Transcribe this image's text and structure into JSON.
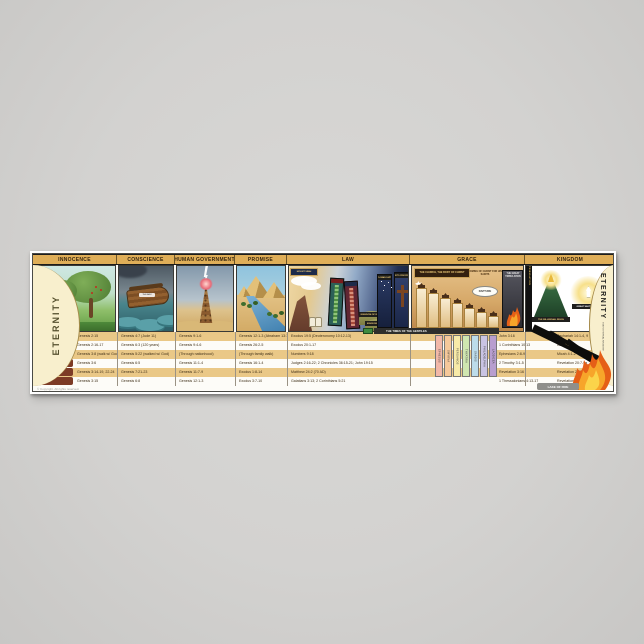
{
  "colors": {
    "page_bg": "#d3d2d0",
    "header_gold": "#dfae58",
    "row_gold": "#eac887",
    "label_maroon": "#7d3b26",
    "eternity_cream": "#f8efcd"
  },
  "poster": {
    "eternity_left": "ETERNITY",
    "eternity_right": "ETERNITY",
    "eternity_right_sub": "GOD'S ETERNAL KINGDOM",
    "headers": [
      "INNOCENCE",
      "CONSCIENCE",
      "HUMAN GOVERNMENT",
      "PROMISE",
      "LAW",
      "GRACE",
      "KINGDOM"
    ],
    "row_labels": [
      "RESPONSIBILITY",
      "RESTRICTION",
      "RELATIONSHIP",
      "RUIN (FAILURE)",
      "RECKONING",
      "REMEDY"
    ],
    "refs": {
      "innocence": [
        "Genesis 2:15",
        "Genesis 2:16-17",
        "Genesis 3:8 (walk w/ God)",
        "Genesis 3:6",
        "Genesis 3:14-19, 22-24",
        "Genesis 3:15"
      ],
      "conscience": [
        "Genesis 4:7 (Jude 11)",
        "Genesis 6:3 (120 years)",
        "Genesis 5:22 (walked w/ God)",
        "Genesis 6:5",
        "Genesis 7:21-23",
        "Genesis 6:8"
      ],
      "human_government": [
        "Genesis 9:1-6",
        "Genesis 9:4-6",
        "(Through nationhood)",
        "Genesis 11:1-4",
        "Genesis 11:7-9",
        "Genesis 12:1-3"
      ],
      "promise": [
        "Genesis 12:1-3 (Abraham 13:14-17)",
        "Genesis 26:2-5",
        "(Through family walk)",
        "Genesis 16:1-4",
        "Exodus 1:8-14",
        "Exodus 3:7-10"
      ],
      "law": [
        "Exodus 19:5 (Deuteronomy 10:12-13)",
        "Exodus 20:1-17",
        "Numbers 9:18",
        "Judges 2:16-22; 2 Chronicles 36:15-21; John 19:15",
        "Matthew 24:2 (70 AD)",
        "Galatians 3:13; 2 Corinthians 5:21"
      ],
      "grace": [
        "John 3:16",
        "1 Corinthians 10:13",
        "Ephesians 2:8-9",
        "2 Timothy 3:1-5",
        "Revelation 3:16",
        "1 Thessalonians 4:13-17"
      ],
      "kingdom": [
        "Zechariah 14:1-4, 9",
        "Isaiah 11:4",
        "Micah 4:1-2",
        "Revelation 20:7-9a",
        "Revelation 20:9b-10",
        "Revelation 21:1-3"
      ]
    },
    "scenes": {
      "conscience": {
        "ark_label": "THE ARK"
      },
      "law": {
        "sinai": "MOUNT SINAI",
        "kingdom_israel": "KINGDOM OF ISRAEL",
        "kingdom_judah": "KINGDOM OF JUDAH",
        "captivity": "BABYLONIAN CAPTIVITY",
        "crucifixion": "CHRIST'S CRUCIFIXION"
      },
      "grace": {
        "banner": "THE CHURCH, THE BODY OF CHRIST",
        "coming": "COMING OF CHRIST FOR HIS SAINTS",
        "rapture": "RAPTURE",
        "tribulation": "THE GREAT TRIBULATION",
        "times_of_gentiles": "THE TIMES OF THE GENTILES",
        "church_ages": [
          {
            "name": "EPHESUS",
            "color": "#f2b8a8"
          },
          {
            "name": "SMYRNA",
            "color": "#f5c89a"
          },
          {
            "name": "PERGAMOS",
            "color": "#f7eaa8"
          },
          {
            "name": "THYATIRA",
            "color": "#cfe6b0"
          },
          {
            "name": "SARDIS",
            "color": "#bcdcea"
          },
          {
            "name": "PHILADELPHIA",
            "color": "#c9c4e4"
          },
          {
            "name": "LAODICEA",
            "color": "#b89ecf"
          }
        ]
      },
      "kingdom": {
        "tribulation_strip": "TRIBULATION",
        "millennial": "THE MILLENNIAL REIGN",
        "throne": "GREAT WHITE THRONE",
        "wedge1": "ARMAGEDDON",
        "wedge2": "GOG & MAGOG",
        "lake_of_fire": "LAKE OF FIRE"
      }
    },
    "copyright": "© Copyright. All rights reserved."
  }
}
